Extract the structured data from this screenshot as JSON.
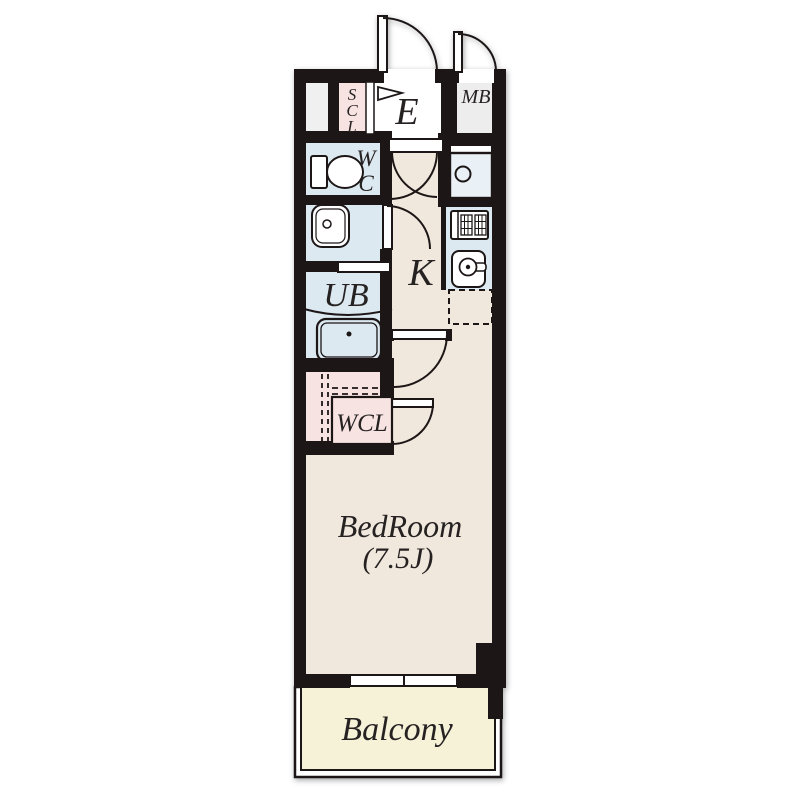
{
  "labels": {
    "entrance": "E",
    "meter_box": "MB",
    "scl": [
      "S",
      "C",
      "L"
    ],
    "wc": [
      "W",
      "C"
    ],
    "unit_bath": "UB",
    "kitchen": "K",
    "walk_in_closet": "WCL",
    "bedroom": "BedRoom",
    "bedroom_size": "(7.5J)",
    "balcony": "Balcony"
  },
  "colors": {
    "wall": "#1d1618",
    "floor_beige": "#f0e8dc",
    "wet_area_blue": "#dce9f0",
    "closet_pink": "#f7e4e2",
    "meterbox_gray": "#ededed",
    "balcony_yellow": "#f5f2d7",
    "text": "#272124"
  }
}
